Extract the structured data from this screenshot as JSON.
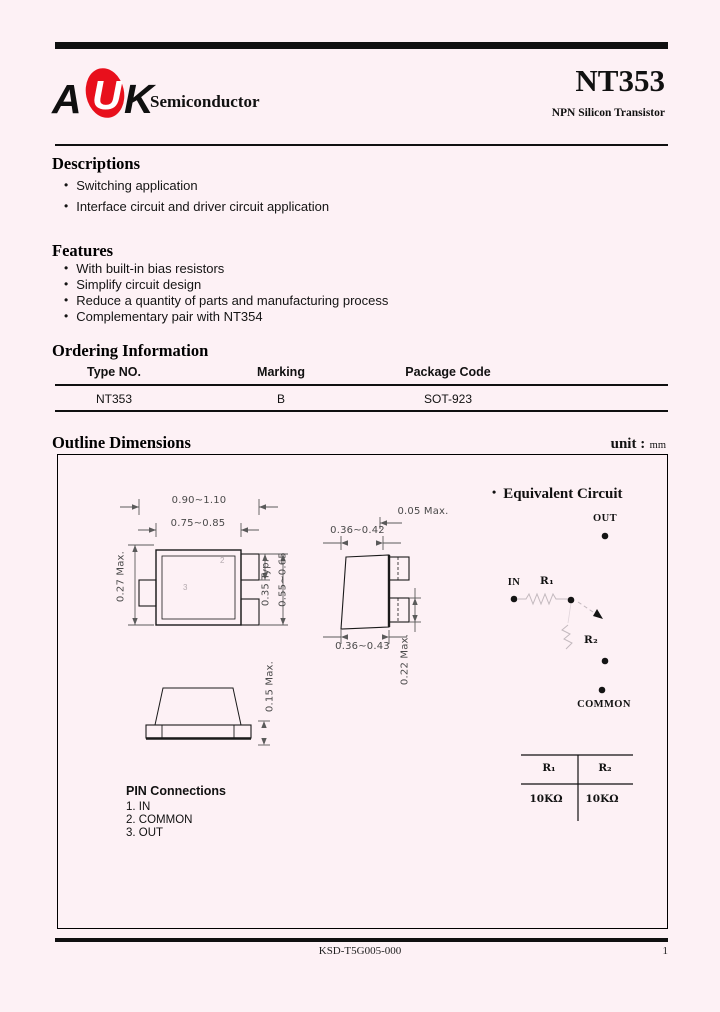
{
  "colors": {
    "background": "#fdf1f5",
    "ink": "#000000",
    "logo_red": "#e8101c",
    "faint_gray": "#c3b9be"
  },
  "header": {
    "logo_a": "A",
    "logo_u": "U",
    "logo_k": "K",
    "company": "Semiconductor",
    "part_number": "NT353",
    "subtitle": "NPN Silicon Transistor"
  },
  "descriptions": {
    "title": "Descriptions",
    "items": [
      "Switching application",
      "Interface circuit and driver circuit application"
    ]
  },
  "features": {
    "title": "Features",
    "items": [
      "With built-in bias resistors",
      "Simplify circuit design",
      "Reduce a quantity of parts and manufacturing process",
      "Complementary pair with NT354"
    ]
  },
  "ordering": {
    "title": "Ordering Information",
    "headers": [
      "Type NO.",
      "Marking",
      "Package Code"
    ],
    "row": [
      "NT353",
      "B",
      "SOT-923"
    ]
  },
  "outline": {
    "title": "Outline Dimensions",
    "unit_label": "unit :",
    "unit_value": "mm",
    "dims": {
      "body_width_outer": "0.90~1.10",
      "body_width_inner": "0.75~0.85",
      "lead_length": "0.27 Max.",
      "lead_width": "0.35 Typ.",
      "lead_span": "0.55~0.65",
      "side_width_top": "0.36~0.42",
      "side_width_bottom": "0.36~0.43",
      "standoff": "0.05 Max.",
      "lead_thickness": "0.22 Max.",
      "height": "0.15 Max."
    },
    "pin_numbers": {
      "pin2": "2",
      "pin3": "3"
    },
    "circuit": {
      "title": "Equivalent Circuit",
      "out": "OUT",
      "in": "IN",
      "r1": "R₁",
      "r2": "R₂",
      "common": "COMMON"
    },
    "resistor_table": {
      "col1": "R₁",
      "col2": "R₂",
      "val1": "10KΩ",
      "val2": "10KΩ"
    },
    "pins": {
      "title": "PIN Connections",
      "items": [
        "1. IN",
        "2. COMMON",
        "3. OUT"
      ]
    }
  },
  "footer": {
    "code": "KSD-T5G005-000",
    "page": "1"
  }
}
